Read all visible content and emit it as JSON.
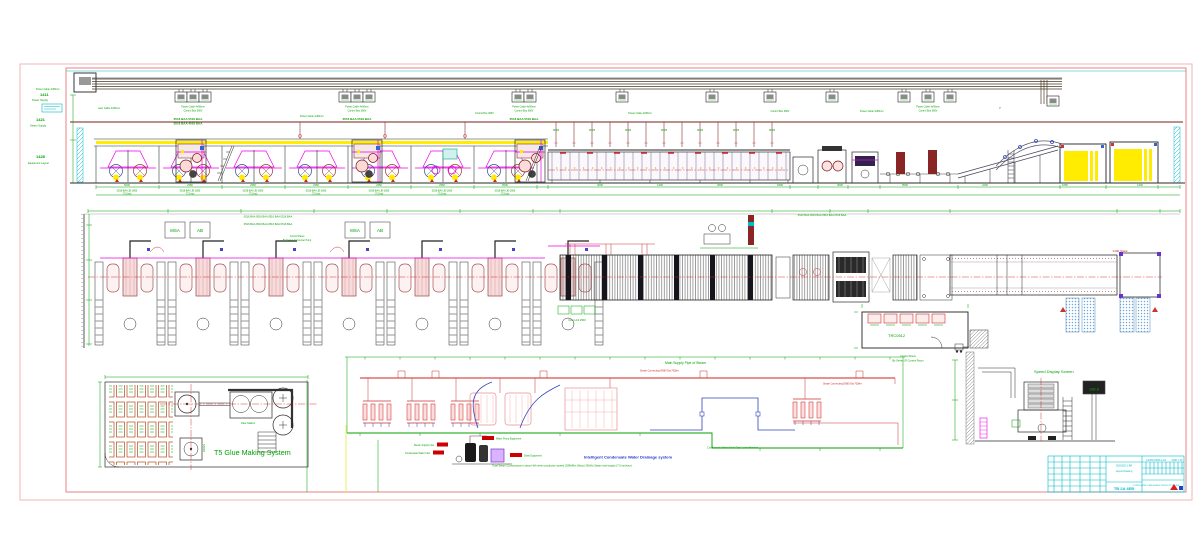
{
  "colors": {
    "frame_outer": "#f2b4b4",
    "frame_inner": "#e88080",
    "cyan": "#00b9c9",
    "green": "#00a000",
    "magenta": "#e800e8",
    "maroon": "#7a1f1f",
    "yellow": "#ffec00",
    "blue": "#3344bb",
    "red": "#cc2222"
  },
  "margin_rows": [
    {
      "code": "1411",
      "label": "Power Supply"
    },
    {
      "code": "1421",
      "label": "Steam Supply"
    },
    {
      "code": "1428",
      "label": "Equipment Layout"
    }
  ],
  "tray": {
    "label1": "Power Cable 4x95mm",
    "label2": "Control Box 380V",
    "codes": "0516 BAA  0516 BAA",
    "codes2": "0516 BAA  4516 BAA"
  },
  "bays": {
    "l1": "0518-BAA JD-1800",
    "l2": "(7.5 kw)"
  },
  "dims": [
    "5200",
    "2350",
    "2350",
    "2350",
    "2350",
    "2350",
    "6500",
    "2000",
    "1400",
    "2500",
    "1800",
    "3000",
    "5500",
    "2200",
    "1650",
    "1200"
  ],
  "plan": {
    "box1": "MSA",
    "box2": "AB",
    "labels_row": "0516 BAA  0516 BAA  0516 BAA  0516 BAA",
    "labels_row2": "0516 BAA  0516 BAA  0516 BAA  0516 BAA",
    "control_panel": "Control Panel",
    "control_panel2": "By Series In Counter Point",
    "glue_unit": "Glue Unit 2500",
    "room_code": "TRC0512",
    "room_note1": "Control Room",
    "room_note2": "By Series Of Control Room",
    "stack": "1400 Stack"
  },
  "schematic": {
    "steam_main": "Main Supply Pipe of Steam",
    "condensate": "Condensate Water Main Pipe Lower Bracket",
    "title": "Intelligent Condensate Water Drainage system",
    "note": "Total Steam Consumption is about 4t/h when production speed 250M/Min (About 300t/h) Steam total supply (7.5 ton/hour)",
    "steam_conn": "Steam Connecting DN80 Dia 700t/hr",
    "lbl_inlet": "Steam Supply Inlet",
    "lbl_cond": "Condensate Water Inlet",
    "lbl_pump": "Water Pump Equipment",
    "lbl_drain": "Drain Equipment",
    "dn": "DN25"
  },
  "glue_room": {
    "title": "T5 Glue Making System",
    "station": "Glue Station",
    "drain": "DRAIN"
  },
  "speed": {
    "label": "Speed Display Screen",
    "value": "188.8"
  },
  "title_block": {
    "no": "A1250-2500-2-01",
    "date": "2008-7-19",
    "mid1": "2500/250-1.8M",
    "mid2": "Layout Drawing",
    "big": "TB 2A 4EB",
    "long": "CORRUGATED CARDBOARD PRODUCTION LINE"
  }
}
